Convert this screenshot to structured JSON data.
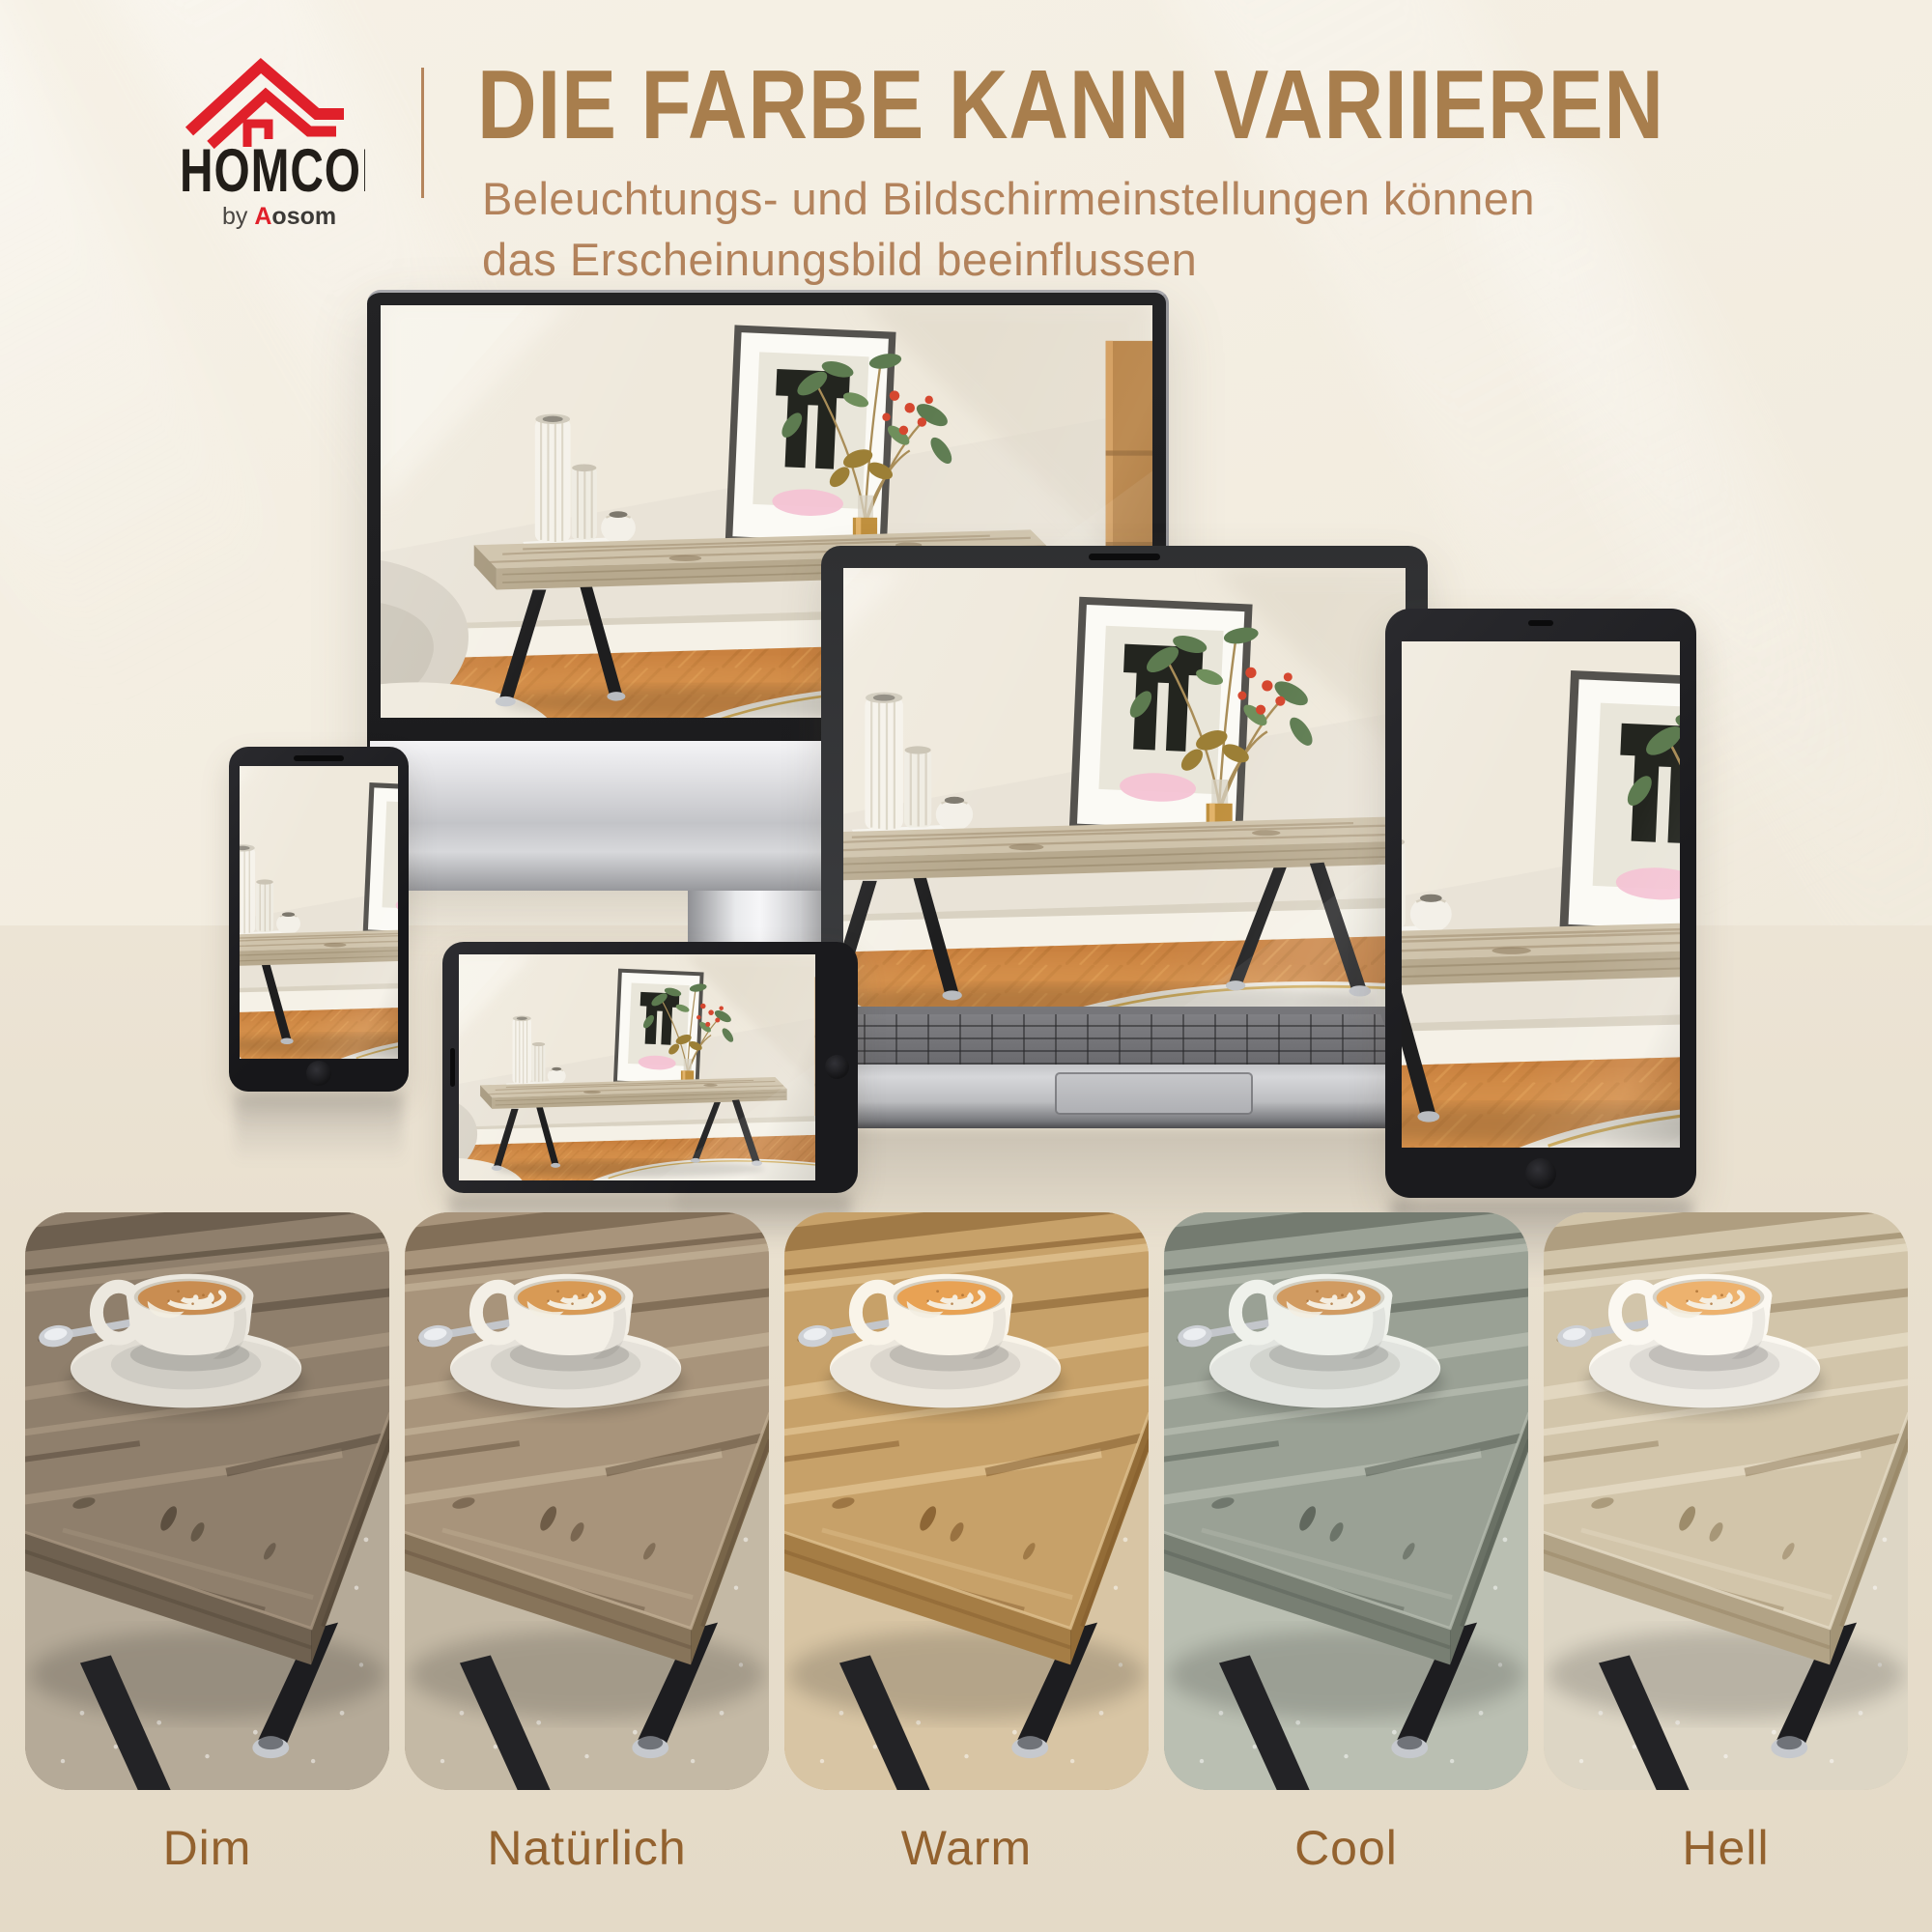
{
  "brand": {
    "name": "HOMCOM",
    "byline_prefix": "by ",
    "byline_initial": "A",
    "byline_rest": "osom"
  },
  "header": {
    "headline": "DIE FARBE KANN VARIIEREN",
    "subtitle_line1": "Beleuchtungs- und Bildschirmeinstellungen können",
    "subtitle_line2": "das Erscheinungsbild beeinflussen"
  },
  "colors": {
    "heading": "#a87e4d",
    "subtitle": "#b3835c",
    "label": "#93622f",
    "divider": "#b5855c",
    "logo_red": "#e0202a",
    "logo_dark": "#221e19",
    "bg_wall": "#f2ecdf",
    "bg_floor": "#e9e0cf"
  },
  "swatches": [
    {
      "label": "Dim",
      "vars": {
        "wood": "#8f7f6c",
        "woodL": "#a6957f",
        "woodSide": "#6f6150",
        "woodEnd": "#625443",
        "grain": "#4b3f31",
        "carpet": "#b5aa98",
        "coffee": "#c98d51",
        "cup": "#ece8df"
      }
    },
    {
      "label": "Natürlich",
      "vars": {
        "wood": "#a8947b",
        "woodL": "#c0ae94",
        "woodSide": "#87745a",
        "woodEnd": "#786549",
        "grain": "#5b4936",
        "carpet": "#c4b9a5",
        "coffee": "#d89a55",
        "cup": "#f3efe6"
      }
    },
    {
      "label": "Warm",
      "vars": {
        "wood": "#c7a169",
        "woodL": "#dfc08e",
        "woodSide": "#a57d45",
        "woodEnd": "#936c37",
        "grain": "#7a5326",
        "carpet": "#d8c5a4",
        "coffee": "#e8a254",
        "cup": "#f9f4e9"
      }
    },
    {
      "label": "Cool",
      "vars": {
        "wood": "#9aa195",
        "woodL": "#b4baae",
        "woodSide": "#787f73",
        "woodEnd": "#6a7165",
        "grain": "#4e564c",
        "carpet": "#babfb2",
        "coffee": "#d19b61",
        "cup": "#eff1eb"
      }
    },
    {
      "label": "Hell",
      "vars": {
        "wood": "#d2c5aa",
        "woodL": "#e5dbc5",
        "woodSide": "#b2a386",
        "woodEnd": "#a39476",
        "grain": "#8b7856",
        "carpet": "#ddd6c5",
        "coffee": "#edb26e",
        "cup": "#fbf8f1"
      }
    }
  ],
  "devices": [
    "monitor",
    "laptop",
    "tablet",
    "phone-portrait",
    "phone-landscape"
  ]
}
